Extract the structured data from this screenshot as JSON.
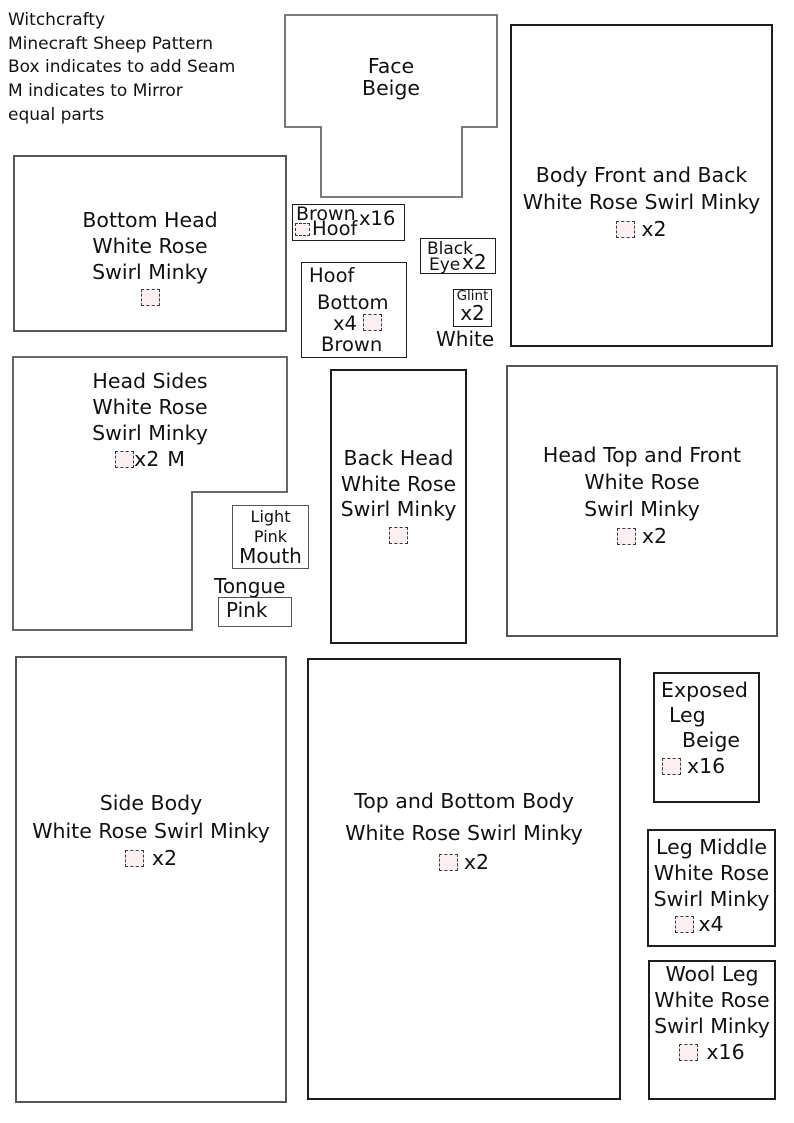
{
  "colors": {
    "background": "#ffffff",
    "text": "#111111",
    "piece_border_gray": "#565656",
    "piece_border_dark": "#1e1e1e",
    "seam_box_fill": "#fbeff1",
    "seam_box_border": "#3b3b3b"
  },
  "title_block": {
    "line1": "Witchcrafty",
    "line2": "Minecraft Sheep Pattern",
    "line3": "Box indicates to add Seam",
    "line4": "M indicates to Mirror",
    "line5": "equal parts"
  },
  "pieces": {
    "face": {
      "name": "Face",
      "fabric": "Beige"
    },
    "body_front_back": {
      "line1": "Body Front and Back",
      "line2": "White Rose Swirl Minky",
      "count": "x2"
    },
    "bottom_head": {
      "line1": "Bottom Head",
      "line2": "White Rose",
      "line3": "Swirl Minky"
    },
    "brown_hoof": {
      "fabric": "Brown",
      "count": "x16",
      "name": "Hoof"
    },
    "hoof_bottom": {
      "line1": "Hoof",
      "line2": "Bottom",
      "count": "x4",
      "fabric": "Brown"
    },
    "black_eye": {
      "line1": "Black",
      "line2": "Eye",
      "count": "x2"
    },
    "glint": {
      "name": "Glint",
      "count": "x2",
      "fabric": "White"
    },
    "head_sides": {
      "line1": "Head Sides",
      "line2": "White Rose",
      "line3": "Swirl Minky",
      "count": "x2",
      "mirror": "M"
    },
    "light_pink_mouth": {
      "line1": "Light",
      "line2": "Pink",
      "line3": "Mouth"
    },
    "tongue": {
      "label": "Tongue",
      "fabric": "Pink"
    },
    "back_head": {
      "line1": "Back Head",
      "line2": "White Rose",
      "line3": "Swirl Minky"
    },
    "head_top_front": {
      "line1": "Head Top and Front",
      "line2": "White Rose",
      "line3": "Swirl Minky",
      "count": "x2"
    },
    "side_body": {
      "line1": "Side Body",
      "line2": "White Rose Swirl Minky",
      "count": "x2"
    },
    "top_bottom_body": {
      "line1": "Top and Bottom Body",
      "line2": "White Rose Swirl Minky",
      "count": "x2"
    },
    "exposed_leg": {
      "line1": "Exposed",
      "line2": "Leg",
      "line3": "Beige",
      "count": "x16"
    },
    "leg_middle": {
      "line1": "Leg Middle",
      "line2": "White Rose",
      "line3": "Swirl Minky",
      "count": "x4"
    },
    "wool_leg": {
      "line1": "Wool Leg",
      "line2": "White Rose",
      "line3": "Swirl Minky",
      "count": "x16"
    }
  }
}
